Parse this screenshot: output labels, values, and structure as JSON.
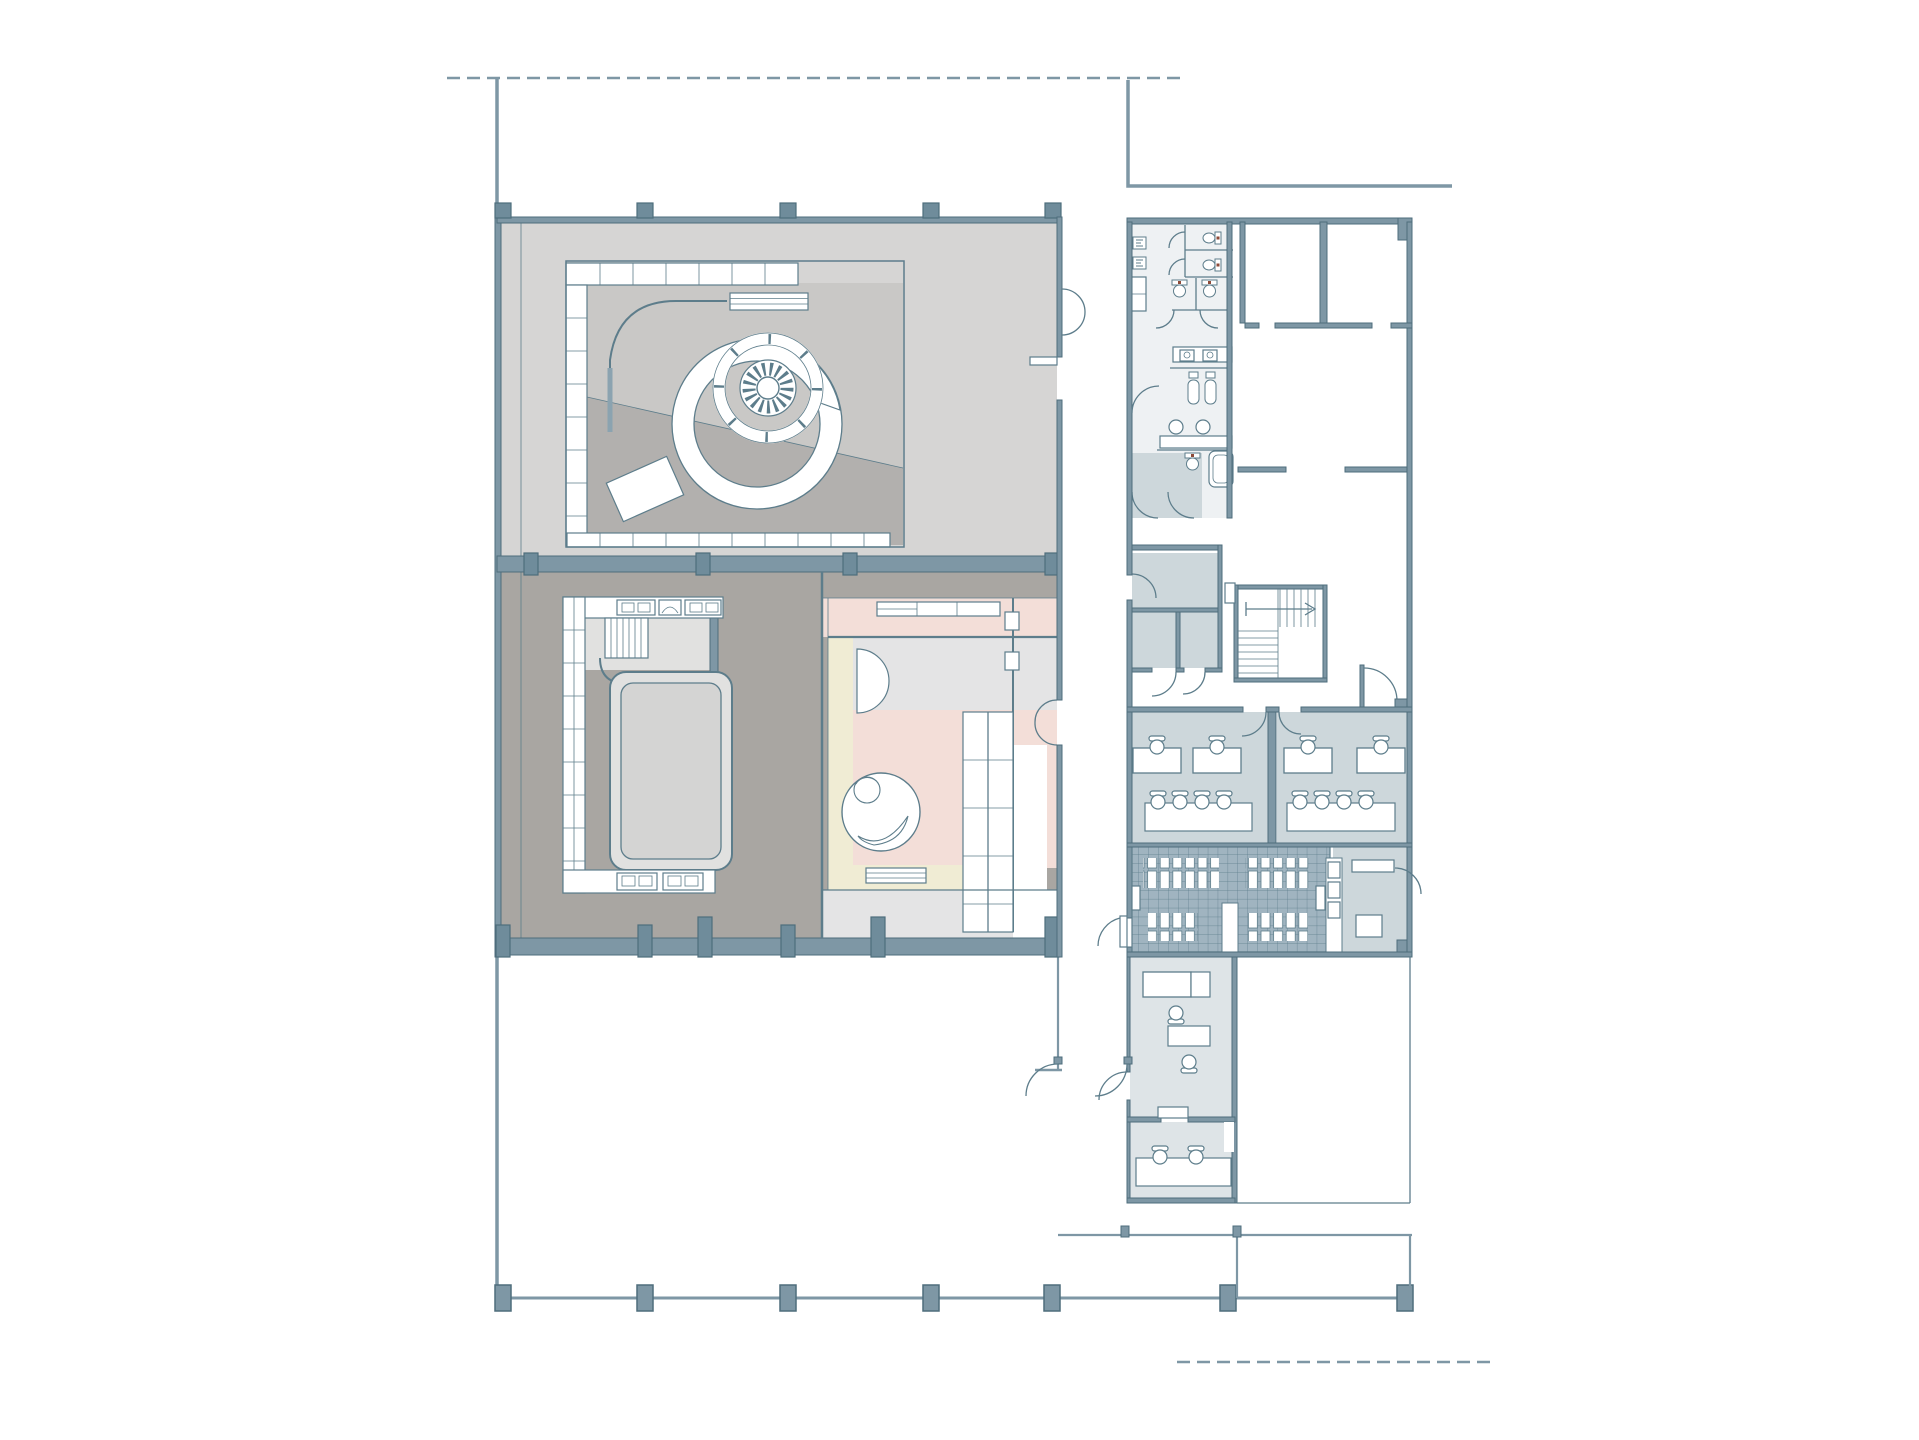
{
  "palette": {
    "wall": "#7e97a5",
    "wallDeep": "#6f8c9b",
    "line": "#5d7d8b",
    "lineDark": "#4e6d7c",
    "floorLight": "#d6d5d4",
    "floorMid": "#c9c8c6",
    "floorDark": "#b2b0ae",
    "taupe": "#a9a6a2",
    "backstage": "#e1e1e0",
    "neutral": "#e4e4e5",
    "pink": "#f3ded8",
    "cream": "#f0ecd4",
    "blueRoom": "#cdd7db",
    "blueLight": "#dee4e7",
    "sanitary": "#eef1f3",
    "locker": "#a0b4c0",
    "accent": "#8e4a38",
    "curtain": "#8ba3b0",
    "background": "#ffffff"
  },
  "drawing": {
    "type": "architectural-floor-plan",
    "site": {
      "property_line_top": true,
      "property_line_bottom_right": true,
      "colonnade_column_count": 7,
      "terrace_open_area": true
    },
    "left_block": {
      "upper_hall": {
        "features": [
          "perimeter-truss-panels",
          "spiral-ramp-ring",
          "radial-sunburst-platform",
          "curtain-track",
          "striped-batten",
          "diagonal-floor-split",
          "tilted-panel"
        ],
        "top_wall_pier_count": 5
      },
      "lower_hall": {
        "features": [
          "truss-panel-wall",
          "side-stair",
          "rounded-platform",
          "control-console-top",
          "control-console-bottom"
        ],
        "bottom_wall_pier_count": 6
      },
      "pink_suite": {
        "features": [
          "cabinet-band",
          "semicircle-door",
          "round-lounge-sofa",
          "wardrobe-units",
          "bench",
          "cream-runner-strips",
          "double-door-east"
        ]
      }
    },
    "right_block": {
      "sanitary_core": {
        "urinals": 2,
        "toilets": 5,
        "square_sinks": 2,
        "round_sinks": 2,
        "showers": 2,
        "bathtub": 1,
        "closet": 1
      },
      "stairwell": {
        "flights": 2,
        "direction_arrow": true
      },
      "upper_rooms": {
        "count": 2,
        "partition_stubs": true
      },
      "vestibule_rooms": {
        "count": 3
      },
      "team_offices": [
        {
          "desks": 2,
          "desk_chairs": 2,
          "meeting_table": 1,
          "meeting_chairs": 4
        },
        {
          "desks": 2,
          "desk_chairs": 2,
          "meeting_table": 1,
          "meeting_chairs": 4
        }
      ],
      "locker_room": {
        "locker_slot_groups": 4,
        "benches": 2,
        "aisles": 2
      },
      "storage_room": {
        "shelf": 1,
        "box": 1
      },
      "manager_office": {
        "desks": 2,
        "chairs": 2
      },
      "meeting_room": {
        "table": 1,
        "chairs": 2
      },
      "south_terrace": true
    }
  }
}
